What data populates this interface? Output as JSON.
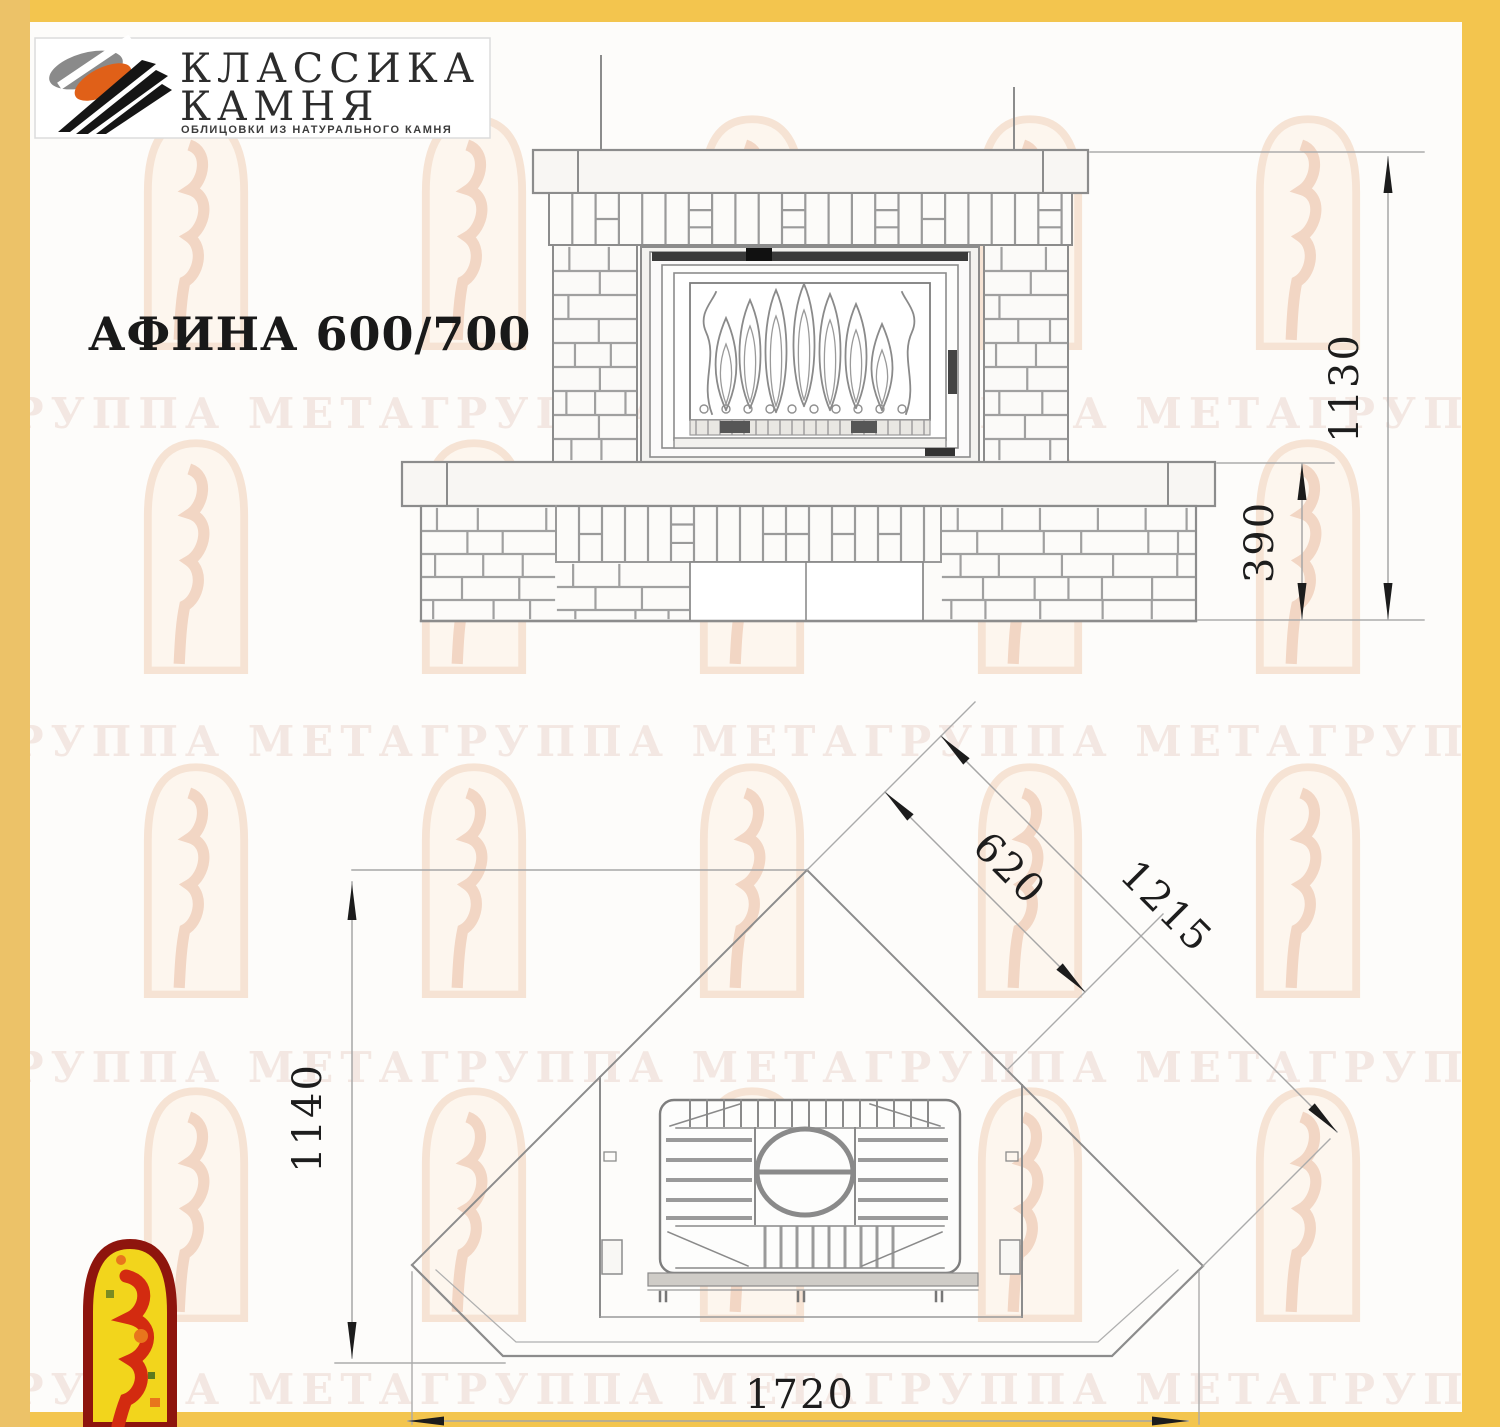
{
  "title": "АФИНА 600/700",
  "logo": {
    "name_line1": "КЛАССИКА",
    "name_line2": "КАМНЯ",
    "tagline": "ОБЛИЦОВКИ ИЗ НАТУРАЛЬНОГО КАМНЯ"
  },
  "watermark": {
    "row_text": "ГРУППА МЕТАГРУППА МЕТАГРУППА МЕТАГРУППА МЕТА"
  },
  "front_view": {
    "dim_total_height": "1130",
    "dim_plinth_height": "390"
  },
  "plan_view": {
    "dim_depth": "1140",
    "dim_firebox_diag": "620",
    "dim_wall_diag": "1215",
    "dim_width": "1720"
  },
  "colors": {
    "frame_yellow": "#f3c54e",
    "left_band_yellow": "#ecc268",
    "line_gray": "#8c8c8c",
    "emblem_red": "#8e150d",
    "emblem_yellow": "#f2d51c"
  }
}
